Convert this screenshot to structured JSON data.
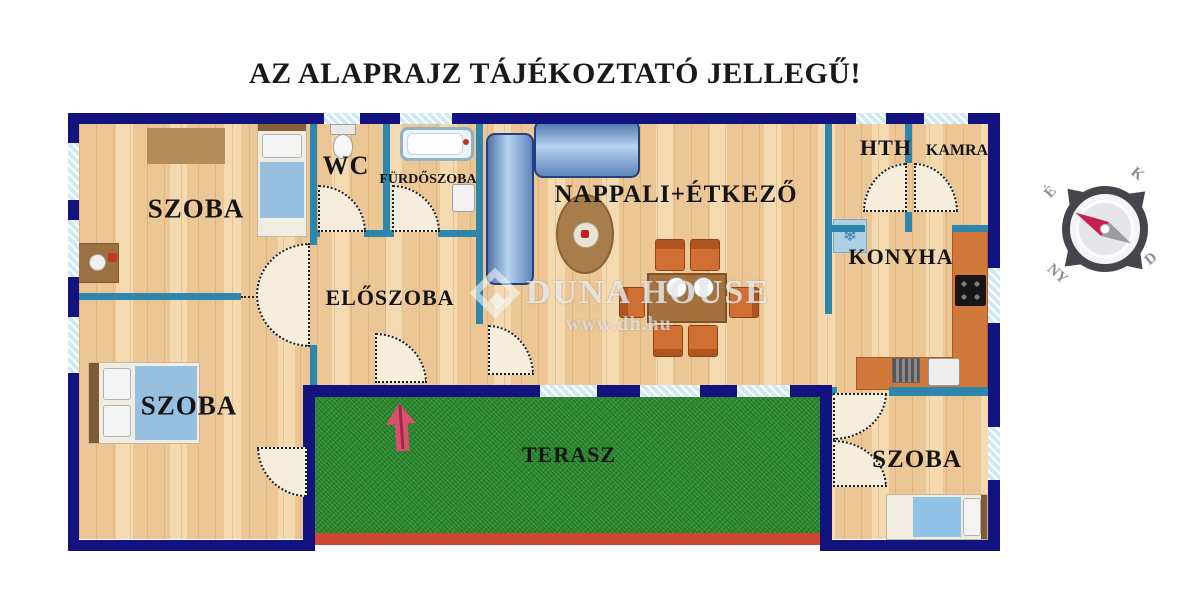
{
  "title": "AZ ALAPRAJZ TÁJÉKOZTATÓ JELLEGŰ!",
  "rooms": {
    "szoba_top_left": "SZOBA",
    "wc": "WC",
    "furdoszoba": "FÜRDŐSZOBA",
    "eloszoba": "ELŐSZOBA",
    "nappali_etkezo": "NAPPALI+ÉTKEZŐ",
    "hth": "HTH",
    "kamra": "KAMRA",
    "konyha": "KONYHA",
    "szoba_bottom_left": "SZOBA",
    "terasz": "TERASZ",
    "szoba_bottom_right": "SZOBA"
  },
  "watermark": {
    "brand": "DUNA HOUSE",
    "url": "www.dh.hu"
  },
  "compass": {
    "north": "É",
    "east": "K",
    "south": "D",
    "west": "NY"
  },
  "icons": {
    "fridge_snowflake": "❄"
  },
  "colors": {
    "outer_wall": "#131380",
    "inner_wall": "#2e86ad",
    "floor_wood": "#ecc795",
    "terrace_green": "#2f8b33",
    "terrace_edge_red": "#cd4631",
    "window_blue": "#cfe8f6",
    "entry_arrow_pink": "#d8506e",
    "furniture_blue": "#97c0e0",
    "furniture_orange": "#d06f33"
  }
}
